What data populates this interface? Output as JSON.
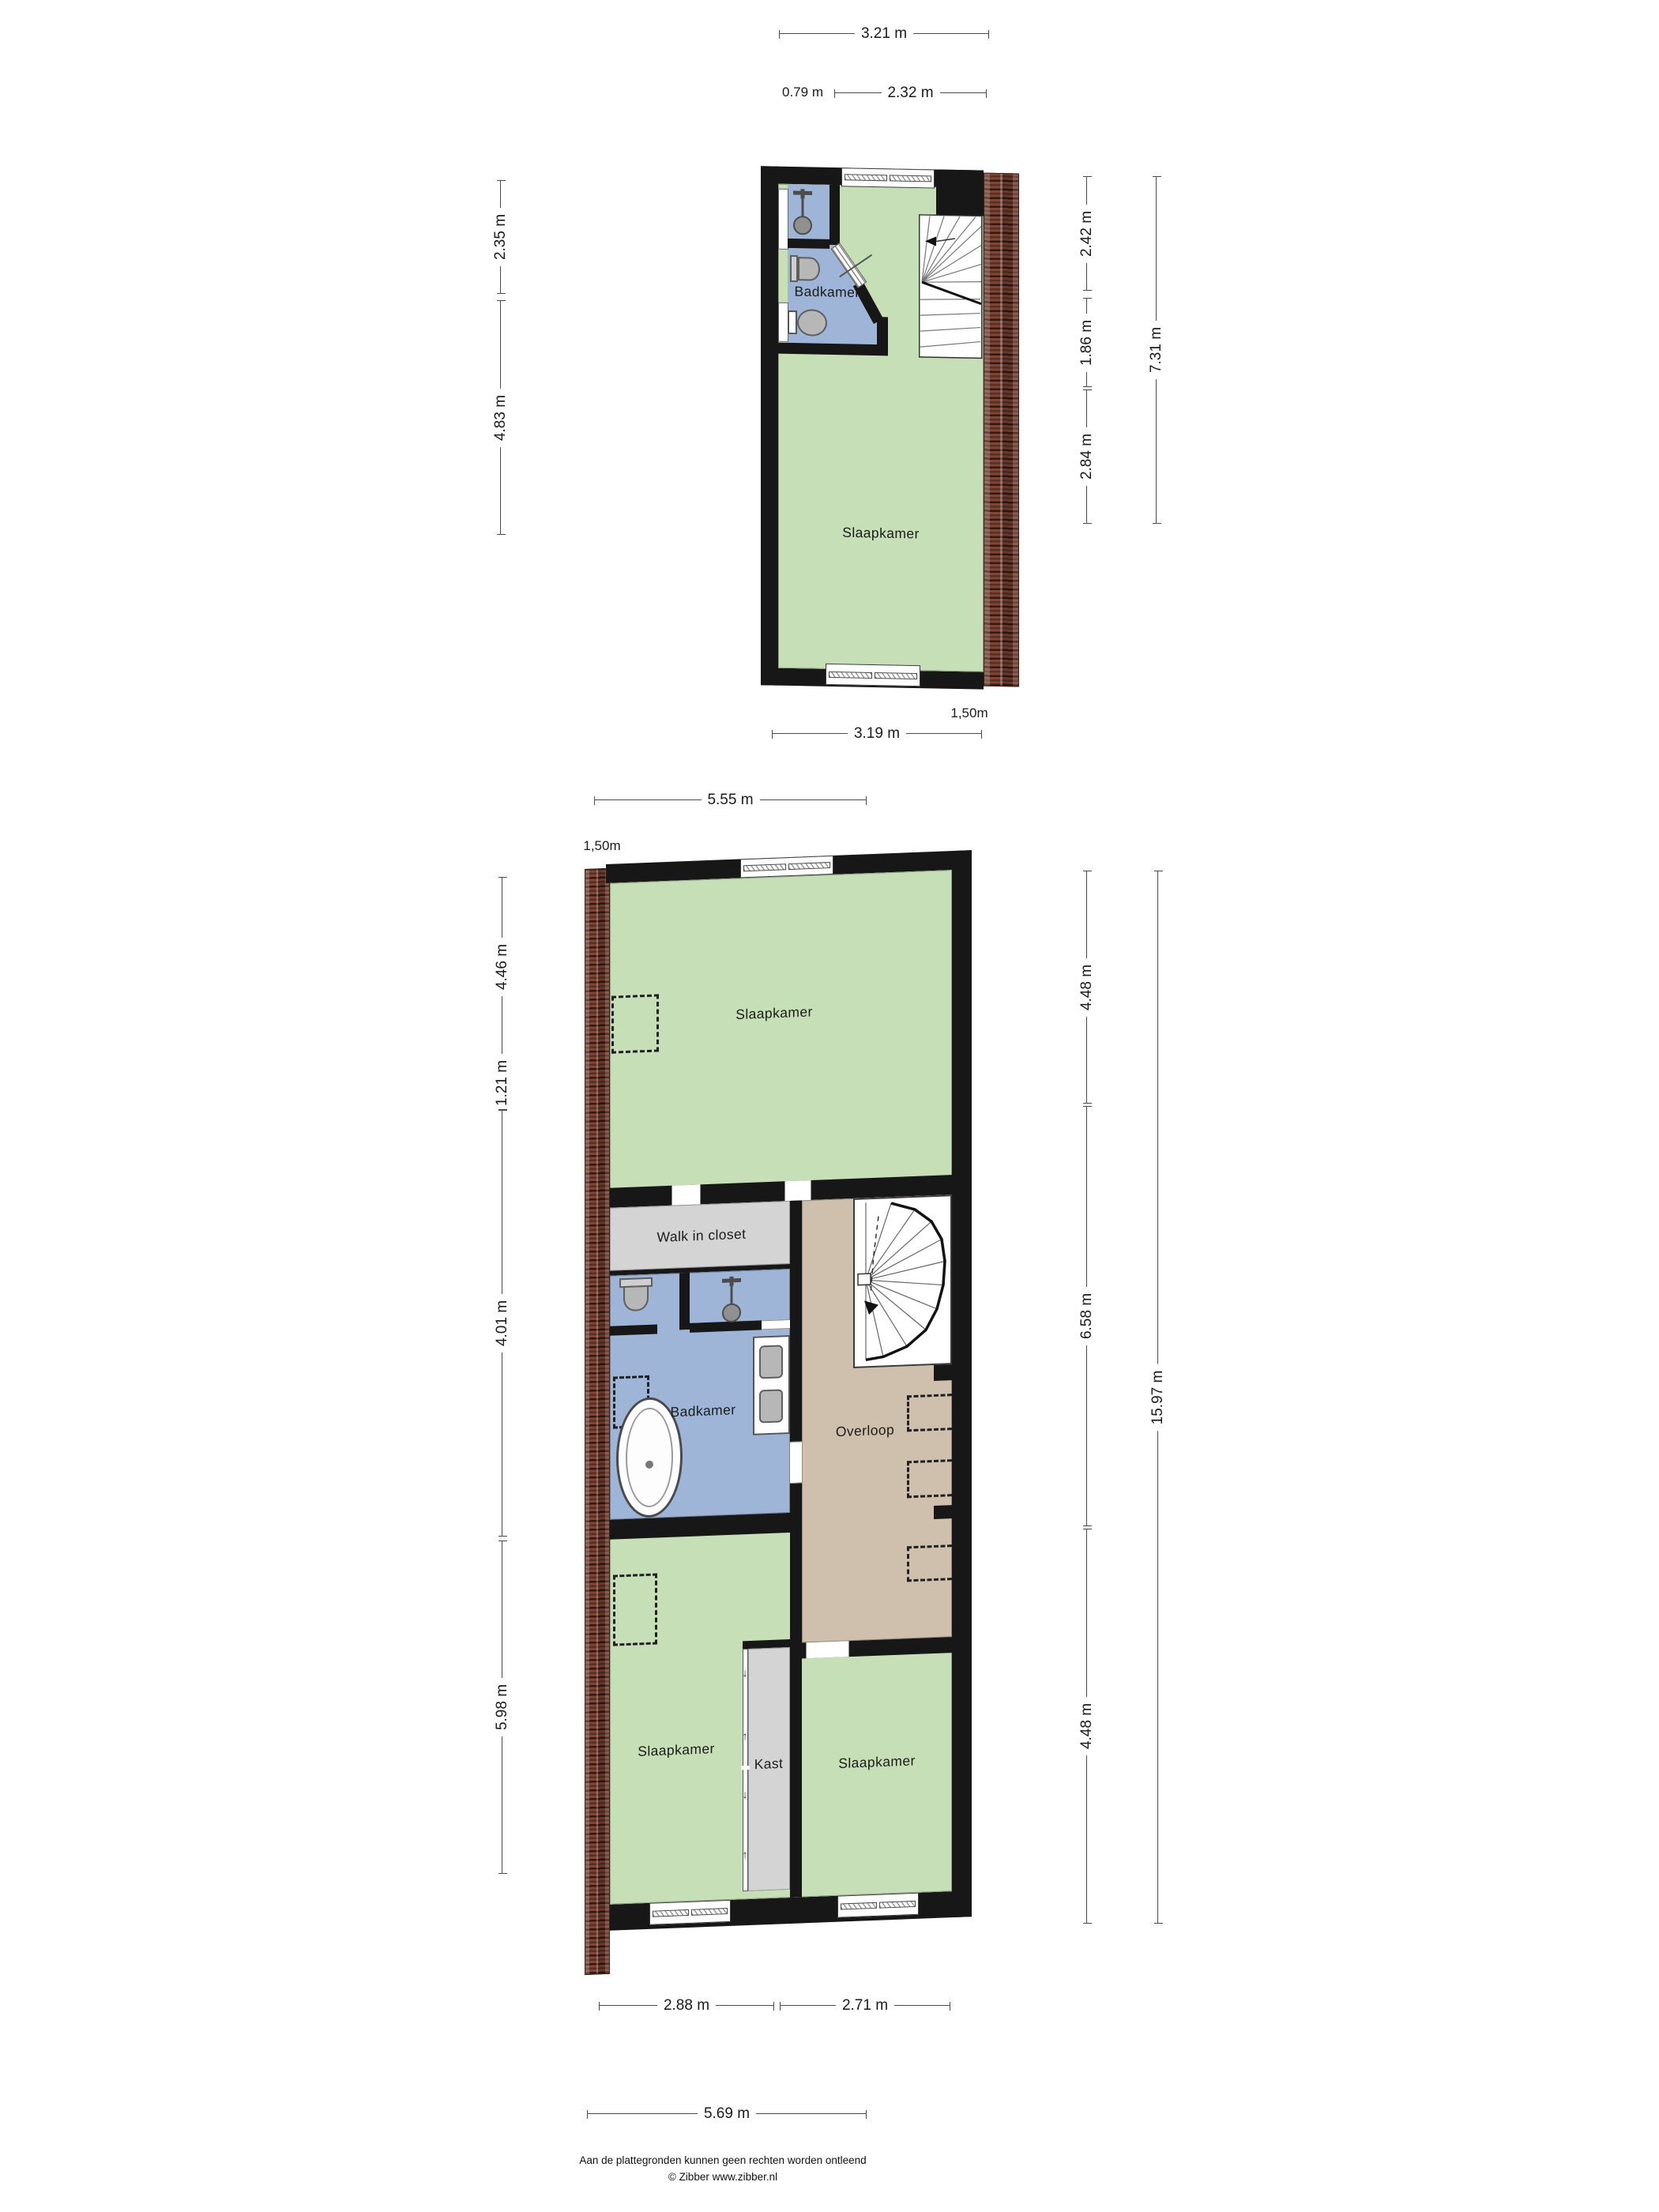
{
  "attic": {
    "rooms": {
      "badkamer": "Badkamer",
      "slaapkamer": "Slaapkamer"
    },
    "dims": {
      "width_total": "3.21 m",
      "width_left": "0.79 m",
      "width_right": "2.32 m",
      "left_upper": "2.35 m",
      "left_lower": "4.83 m",
      "right_seg1": "2.42 m",
      "right_seg2": "1.86 m",
      "right_seg3": "2.84 m",
      "right_total": "7.31 m",
      "bottom_width": "3.19 m",
      "knee_height": "1,50m"
    }
  },
  "floor2": {
    "rooms": {
      "slaapkamer_top": "Slaapkamer",
      "walk_in_closet": "Walk in closet",
      "badkamer": "Badkamer",
      "overloop": "Overloop",
      "slaapkamer_left": "Slaapkamer",
      "kast": "Kast",
      "slaapkamer_right": "Slaapkamer"
    },
    "dims": {
      "top_width": "5.55 m",
      "knee_height": "1,50m",
      "left_seg1": "4.46 m",
      "left_seg2": "1.21 m",
      "left_seg3": "4.01 m",
      "left_seg4": "5.98 m",
      "right_seg1": "4.48 m",
      "right_seg2": "6.58 m",
      "right_seg3": "4.48 m",
      "right_total": "15.97 m",
      "bottom_left": "2.88 m",
      "bottom_right": "2.71 m",
      "bottom_total": "5.69 m"
    }
  },
  "footer": {
    "disclaimer": "Aan de plattegronden kunnen geen rechten worden ontleend",
    "copyright": "© Zibber www.zibber.nl"
  },
  "colors": {
    "room_green": "#c7dfb6",
    "room_blue": "#9fb5d7",
    "room_tan": "#cfc0ad",
    "room_gray": "#d4d4d4",
    "wall": "#171717",
    "brick": "#7d4636",
    "dim_line": "#4a4a4a"
  }
}
